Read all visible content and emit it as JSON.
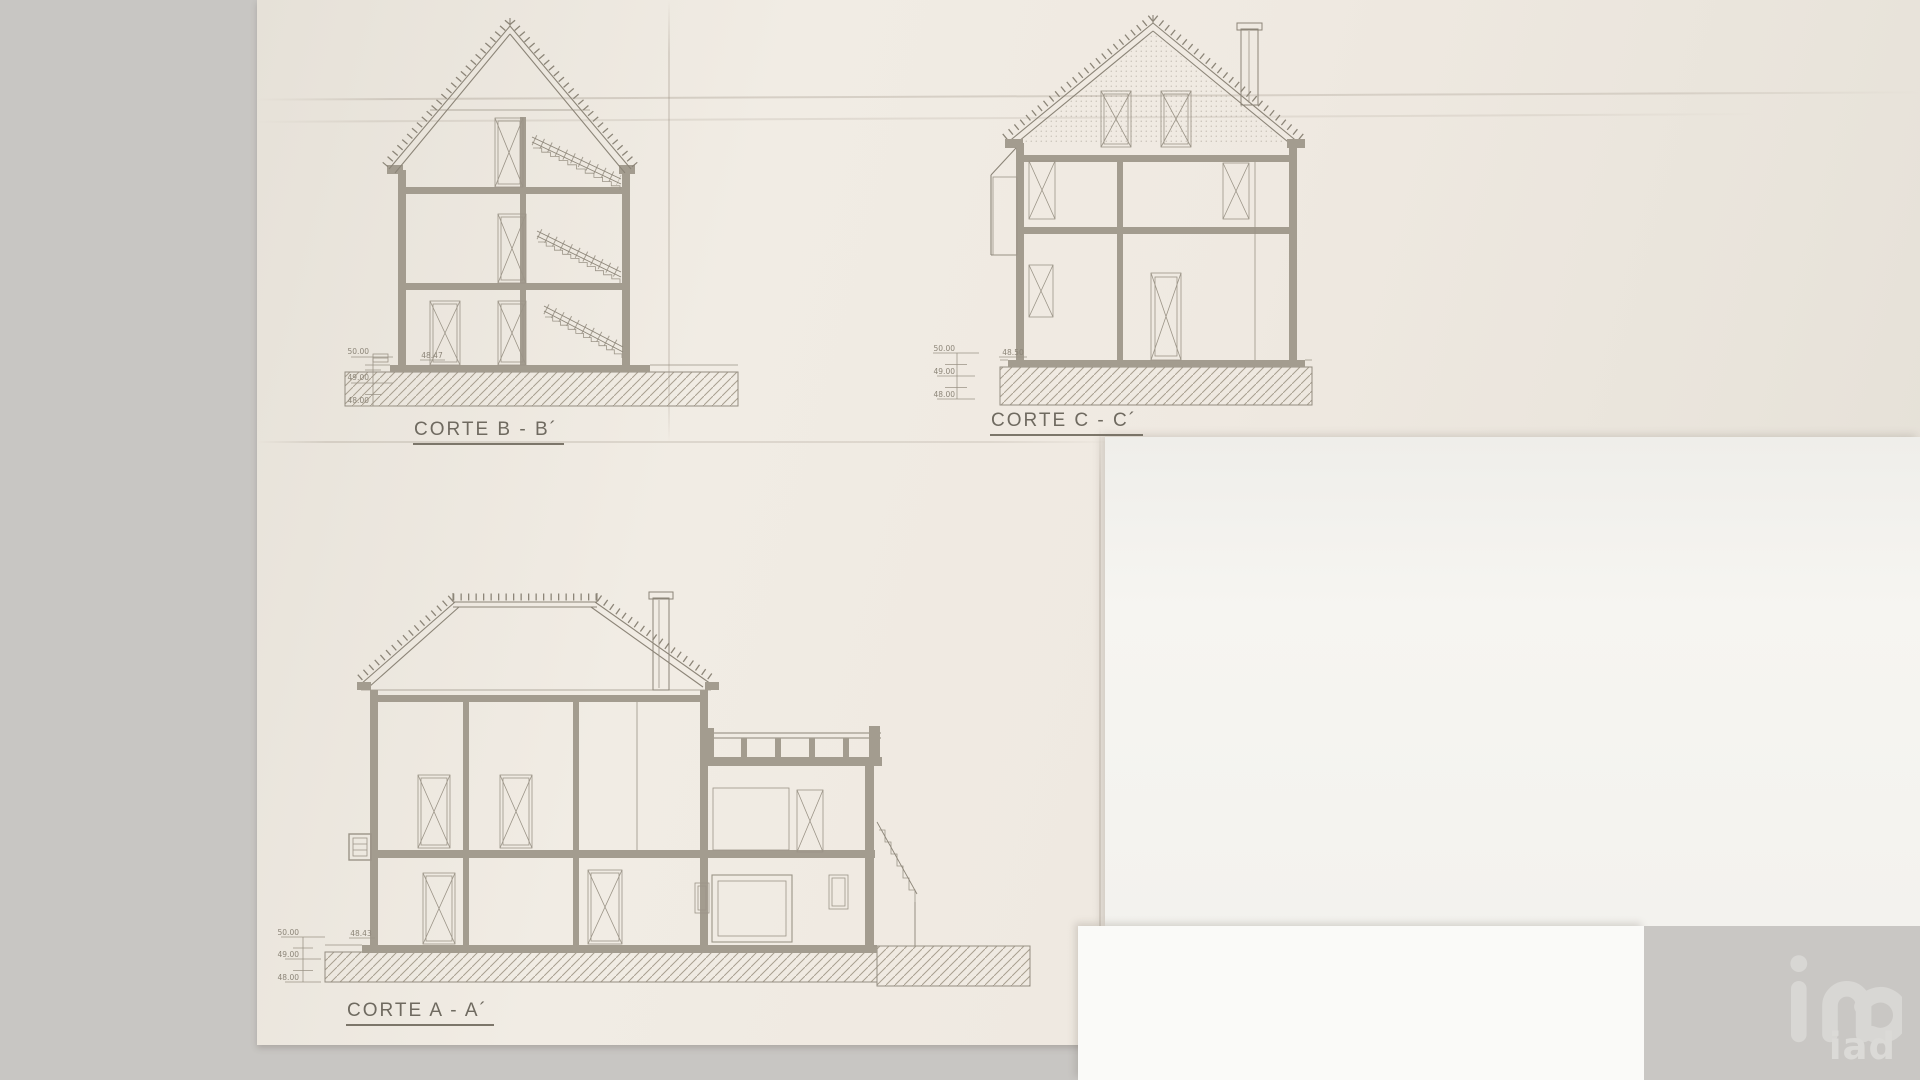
{
  "sections": {
    "corte_b": {
      "title": "CORTE B - B´",
      "ruler_labels": [
        "50.00",
        "49.00",
        "48.00"
      ],
      "base_elevation": "48.47"
    },
    "corte_c": {
      "title": "CORTE C - C´",
      "ruler_labels": [
        "50.00",
        "49.00",
        "48.00"
      ],
      "base_elevation": "48.50"
    },
    "corte_a": {
      "title": "CORTE A - A´",
      "ruler_labels": [
        "50.00",
        "49.00",
        "48.00"
      ],
      "base_elevation": "48.43"
    }
  },
  "watermark": {
    "text": "iad"
  },
  "colors": {
    "background": "#c8c6c3",
    "paper": "#efeae2",
    "paper_white": "#f6f5f2",
    "ink": "#8c8578",
    "wall_fill": "#a39c8f"
  }
}
